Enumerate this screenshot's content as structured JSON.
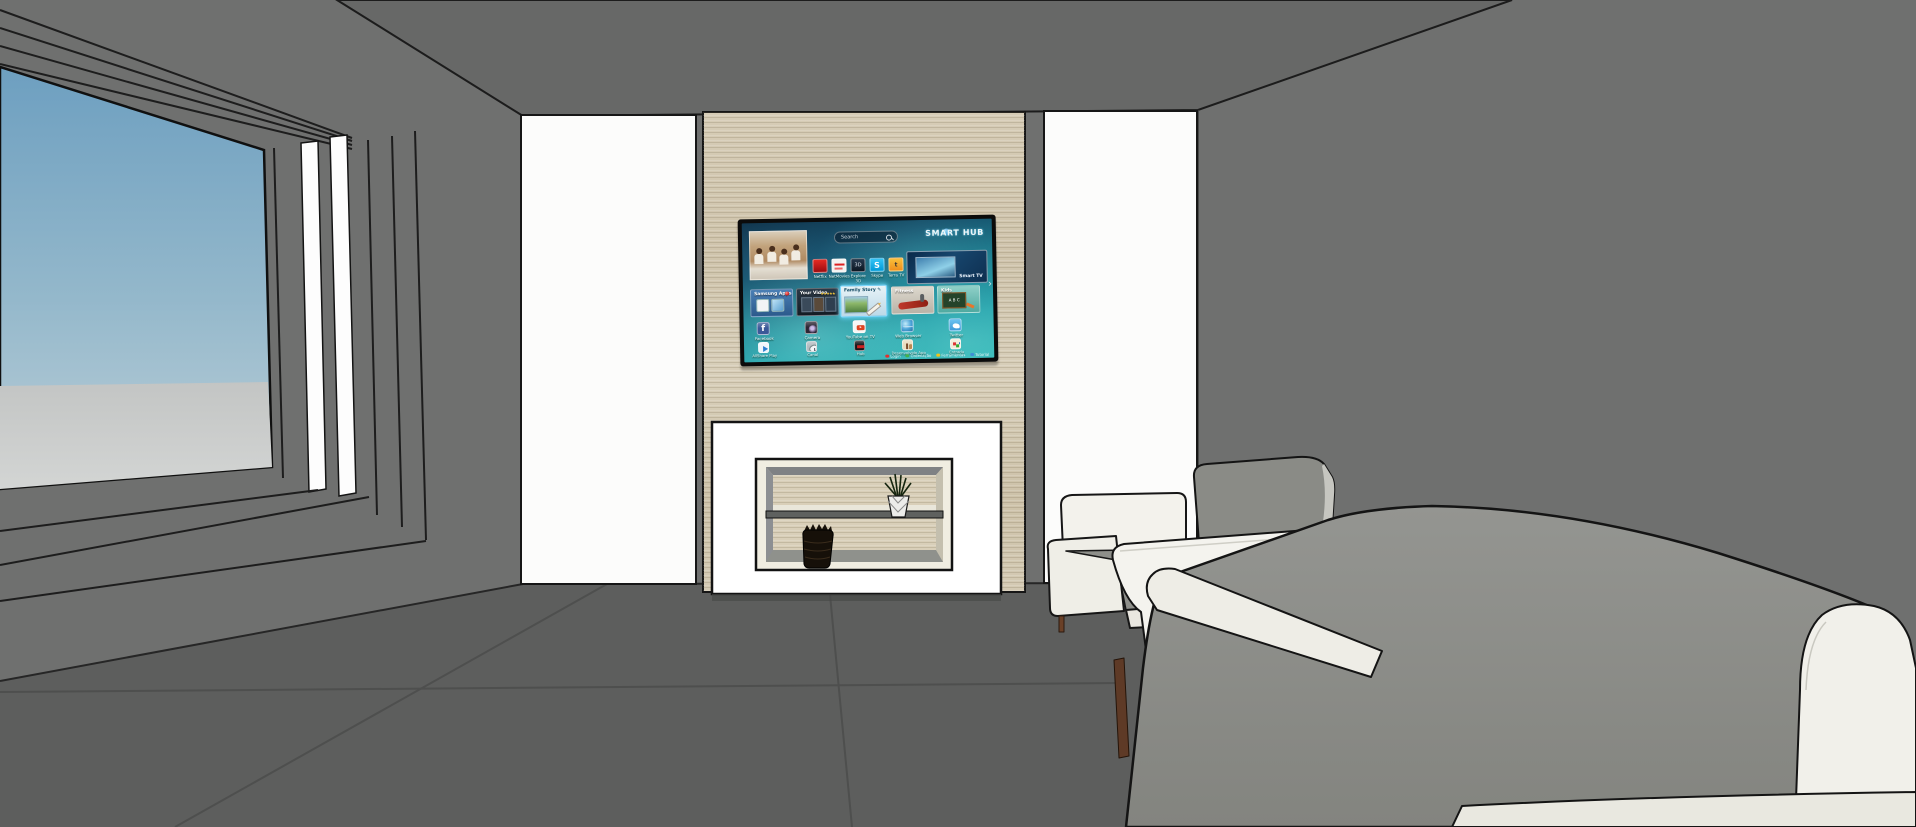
{
  "scene": {
    "colors": {
      "wall": "#6f706f",
      "ceiling": "#676867",
      "floor": "#5d5e5d",
      "floor_seam": "#4e4f4e",
      "wood_panel": "#d2c8b2",
      "alcove_panel_white": "#fcfcfb",
      "fireplace_white": "#ffffff",
      "shelf_frame_cream": "#f0ede1",
      "sky_top": "#6d9fc0",
      "sky_horizon": "#bccfd8",
      "ground": "#c6c8c7",
      "window_trim_white": "#fdfdfd",
      "chair_fabric_white": "#f3f2ec",
      "cushion_gray": "#8a8b86",
      "sofa_back_gray": "#8c8d88",
      "leg_brown": "#5e3a26",
      "tv_bezel_black": "#0b0b0b",
      "screen_teal": "#197e8f"
    }
  },
  "tv": {
    "search_placeholder": "Search",
    "logo": "SMART HUB",
    "pager": "›",
    "promo": {
      "label": "Smart TV"
    },
    "small_apps": [
      {
        "name": "Netflix",
        "color": "#d0021b"
      },
      {
        "name": "NetMovies",
        "color": "#f3f3f1"
      },
      {
        "name": "Explore 3D",
        "color": "#25384d",
        "glyph": "3D"
      },
      {
        "name": "Skype",
        "color": "#00aff0",
        "glyph": "S"
      },
      {
        "name": "Terra TV",
        "color": "#ef8f1d",
        "glyph": "t"
      }
    ],
    "feature_tiles": [
      {
        "name": "Samsung Apps"
      },
      {
        "name": "Your Video",
        "rating": "★★★★★"
      },
      {
        "name": "Family Story",
        "selected": true,
        "glyph": "✎"
      },
      {
        "name": "Fitness"
      },
      {
        "name": "Kids",
        "board_text": "A B C"
      }
    ],
    "apps_row1": [
      "Facebook",
      "Camera",
      "YouTube on TV",
      "Web Browser",
      "Twitter"
    ],
    "apps_row2": [
      "AllShare Play",
      "Canal",
      "Hub",
      "Desenvolvido App",
      "Entrada"
    ],
    "legend": [
      {
        "key_color": "#e0312e",
        "label": "Login"
      },
      {
        "key_color": "#43b14b",
        "label": "Ordenação"
      },
      {
        "key_color": "#f2c416",
        "label": "Ferramentas"
      },
      {
        "key_color": "#3f8fd6",
        "label": "Tutorial"
      }
    ]
  }
}
